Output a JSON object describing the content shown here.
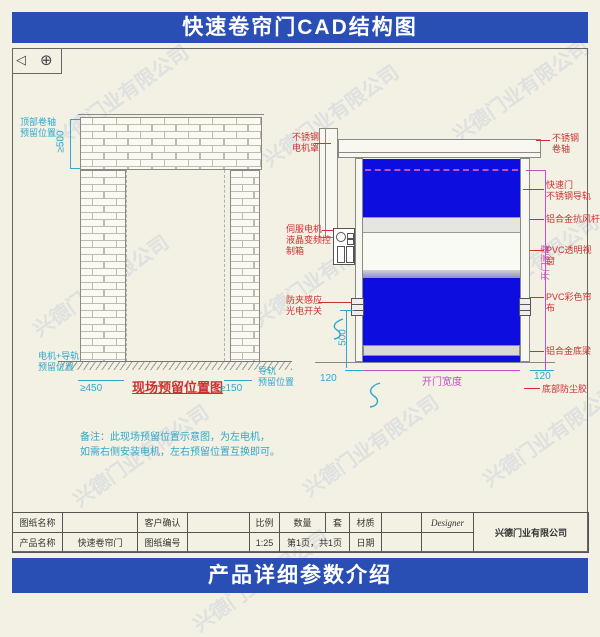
{
  "banners": {
    "top": "快速卷帘门CAD结构图",
    "bottom": "产品详细参数介绍"
  },
  "watermark_text": "兴德门业有限公司",
  "symbols": {
    "projection_triangle": "◁",
    "circle_cross": "⊕"
  },
  "left_view": {
    "caption": "现场预留位置图",
    "label_top_roller": "顶部卷轴\n预留位置",
    "label_motor_rail": "电机+导轨\n预留位置",
    "label_rail": "导轨\n预留位置",
    "dim_top": "≥500",
    "dim_left": "≥450",
    "dim_right": "≥150",
    "note1": "备注：此现场预留位置示意图，为左电机，",
    "note2": "如需右侧安装电机，左右预留位置互换即可。"
  },
  "right_view": {
    "label_motor_cover": "不锈钢\n电机罩",
    "label_control_box": "伺服电机\n液晶变频控制箱",
    "label_sensor": "防夹感应\n光电开关",
    "label_roller": "不锈钢\n卷轴",
    "label_rail": "快速门\n不锈钢导轨",
    "label_wind_bar": "铝合金抗风杆",
    "label_window": "PVC透明视窗",
    "label_curtain": "PVC彩色帘布",
    "label_bottom_beam": "铝合金底梁",
    "label_bottom_seal": "底部防尘胶",
    "dim_sensor_height": "500",
    "dim_rail_left": "120",
    "dim_rail_right": "120",
    "dim_width": "开门宽度",
    "dim_height": "开门高度"
  },
  "title_block": {
    "r1c1": "图纸名称",
    "r1c2": "",
    "r1c3": "客户确认",
    "r1c4": "",
    "r1c5": "比例",
    "r1c6": "数量",
    "r1c7": "套",
    "r1c8": "材质",
    "r1c9": "",
    "r1c10": "Designer",
    "r2c1": "产品名称",
    "r2c2": "快速卷帘门",
    "r2c3": "图纸编号",
    "r2c4": "",
    "r2c5": "1:25",
    "r2c6": "第1页，共1页",
    "r2c7": "日期",
    "r2c8": "",
    "r2c9": "",
    "company": "兴德门业有限公司"
  },
  "colors": {
    "accent_blue": "#2a4fb4",
    "curtain_blue": "#0d0de0",
    "dim_cyan": "#2fa8cc",
    "label_red": "#cc3030",
    "dim_magenta": "#c44ec4"
  }
}
